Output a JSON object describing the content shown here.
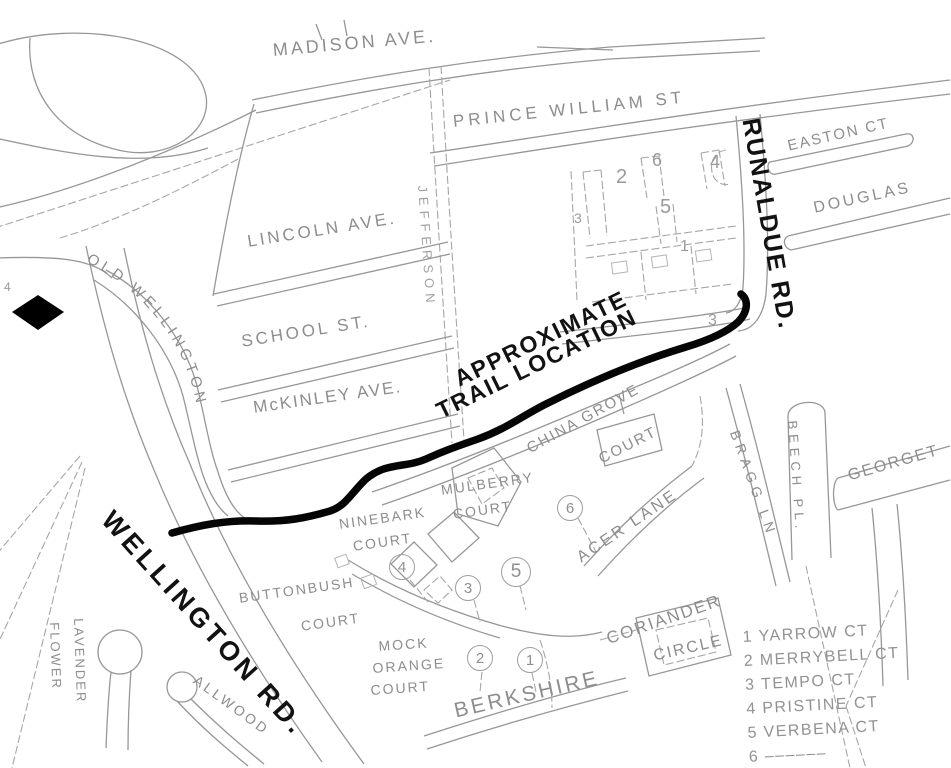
{
  "labels": {
    "trail_line1": "APPROXIMATE",
    "trail_line2": "TRAIL LOCATION",
    "wellington": "WELLINGTON RD.",
    "runaldue": "RUNALDUE RD."
  },
  "streets": {
    "madison": "MADISON AVE.",
    "prince_william": "PRINCE WILLIAM ST",
    "lincoln": "LINCOLN AVE.",
    "school": "SCHOOL ST.",
    "mckinley": "McKINLEY AVE.",
    "old_wellington": "OLD WELLINGTON",
    "jefferson": "JEFFERSON",
    "easton": "EASTON CT",
    "douglas": "DOUGLAS",
    "bragg": "BRAGG LN",
    "beech": "BEECH PL.",
    "georgetown": "GEORGET",
    "china_grove_line1": "CHINA GROVE",
    "china_grove_line2": "COURT",
    "acer": "ACER LANE",
    "coriander_line1": "CORIANDER",
    "coriander_line2": "CIRCLE",
    "berkshire": "BERKSHIRE",
    "mulberry_line1": "MULBERRY",
    "mulberry_line2": "COURT",
    "ninebark_line1": "NINEBARK",
    "ninebark_line2": "COURT",
    "mock_orange_line1": "MOCK",
    "mock_orange_line2": "ORANGE",
    "mock_orange_line3": "COURT",
    "buttonbush_line1": "BUTTONBUSH",
    "buttonbush_line2": "COURT",
    "allwood": "ALLWOOD",
    "lavender_line1": "LAVENDER",
    "lavender_line2": "FLOWER"
  },
  "legend": {
    "items": [
      {
        "num": "1",
        "name": "YARROW CT"
      },
      {
        "num": "2",
        "name": "MERRYBELL CT"
      },
      {
        "num": "3",
        "name": "TEMPO CT"
      },
      {
        "num": "4",
        "name": "PRISTINE CT"
      },
      {
        "num": "5",
        "name": "VERBENA CT"
      },
      {
        "num": "6",
        "name": "––––––"
      }
    ]
  },
  "map_numbers": {
    "circled": [
      "4",
      "3",
      "5",
      "2",
      "1",
      "6"
    ],
    "plain": [
      "2",
      "6",
      "4",
      "5",
      "3",
      "1",
      "3",
      "4"
    ]
  },
  "colors": {
    "background": "#ffffff",
    "road_line": "#979797",
    "street_label": "#8d8d8d",
    "bold_label": "#121212",
    "trail": "#050505",
    "diamond_marker": "#000000"
  }
}
